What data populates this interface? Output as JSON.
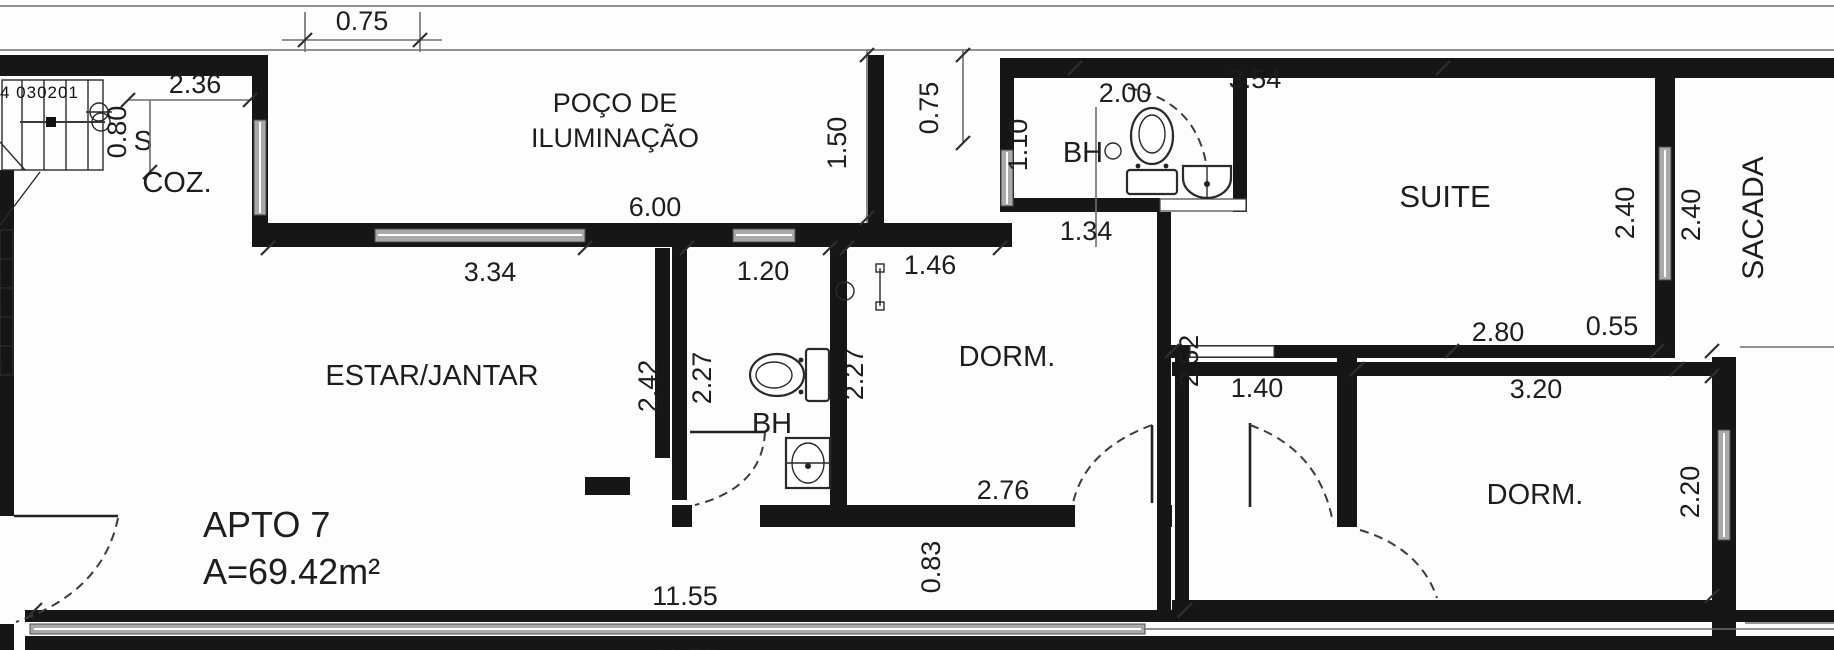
{
  "plan": {
    "apartment": {
      "name": "APTO 7",
      "area": "A=69.42m²"
    },
    "rooms": {
      "kitchen": "COZ.",
      "lightwell_line1": "POÇO DE",
      "lightwell_line2": "ILUMINAÇÃO",
      "living": "ESTAR/JANTAR",
      "bath_mid": "BH",
      "bath_top": "BH",
      "dorm_mid": "DORM.",
      "dorm_right": "DORM.",
      "suite": "SUITE",
      "balcony": "SACADA"
    },
    "stair": {
      "treads": "4 030201",
      "direction": "S",
      "edge_numbers": [
        "2",
        "3",
        "4",
        "5",
        "6"
      ]
    },
    "dims": {
      "top_075": "0.75",
      "coz_236": "2.36",
      "coz_080": "0.80",
      "well_600": "6.00",
      "well_150": "1.50",
      "shaft_075": "0.75",
      "bh_top_200": "2.00",
      "bh_top_110": "1.10",
      "suite_354": "3.54",
      "suite_240": "2.40",
      "sacada_240": "2.40",
      "pass_134": "1.34",
      "estar_334": "3.34",
      "bh_120": "1.20",
      "dorm_146": "1.46",
      "estar_242": "2.42",
      "bh_227": "2.27",
      "dorm_227": "2.27",
      "suite_252": "2.52",
      "hall_140": "1.40",
      "dorm_276": "2.76",
      "dormr_280": "2.80",
      "dormr_055": "0.55",
      "dormr_320": "3.20",
      "dormr_220": "2.20",
      "hall_083": "0.83",
      "total_1155": "11.55",
      "total_1155b": "11.55"
    },
    "colors": {
      "wall": "#161616",
      "window": "#a9a9a9",
      "paper": "#fdfdfd"
    }
  }
}
